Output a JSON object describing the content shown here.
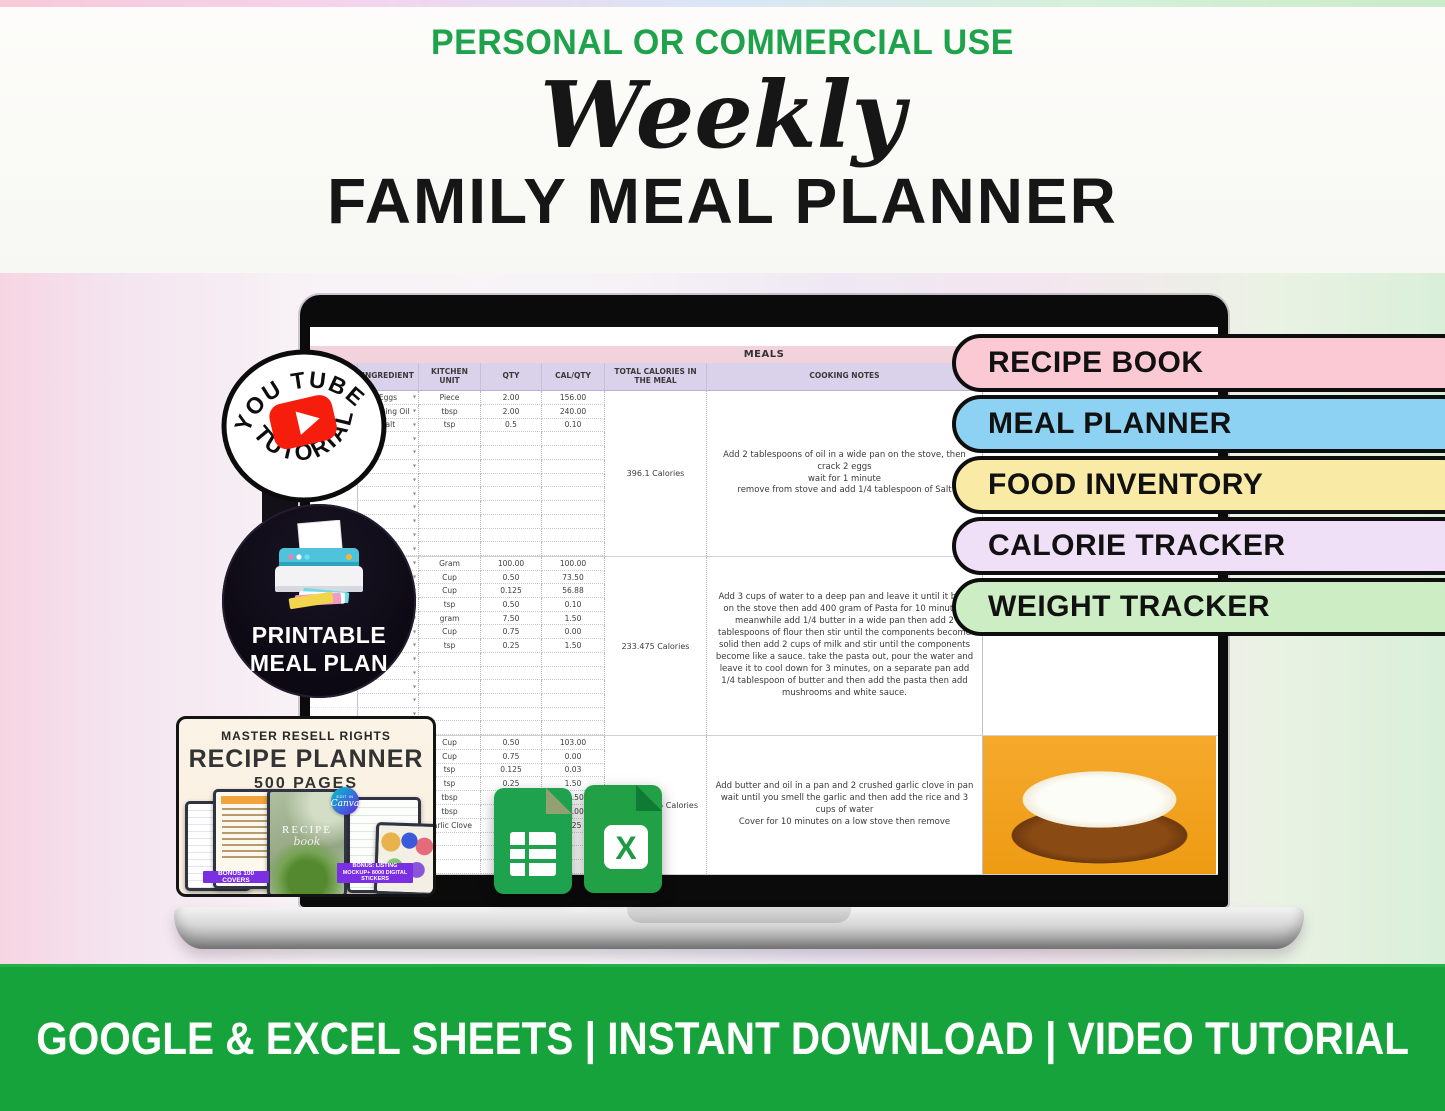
{
  "header": {
    "eyebrow": "PERSONAL OR COMMERCIAL USE",
    "script_title": "Weekly",
    "main_title": "FAMILY MEAL PLANNER"
  },
  "youtube_badge": {
    "top_text": "YOU TUBE",
    "bottom_text": "TUTORIAL"
  },
  "printable_badge": {
    "line1": "PRINTABLE",
    "line2": "MEAL PLAN"
  },
  "feature_pills": [
    {
      "label": "RECIPE BOOK",
      "color": "#fbc9d4"
    },
    {
      "label": "MEAL PLANNER",
      "color": "#8dd1f3"
    },
    {
      "label": "FOOD INVENTORY",
      "color": "#f9eaa6"
    },
    {
      "label": "CALORIE TRACKER",
      "color": "#efdff7"
    },
    {
      "label": "WEIGHT TRACKER",
      "color": "#cdeec5"
    }
  ],
  "spreadsheet": {
    "sheet_title": "MEALS",
    "columns": [
      "INGREDIENT",
      "KITCHEN UNIT",
      "QTY",
      "CAL/QTY",
      "TOTAL CALORIES IN THE MEAL",
      "COOKING NOTES"
    ],
    "meals": [
      {
        "rows": [
          {
            "ingredient": "Eggs",
            "unit": "Piece",
            "qty": "2.00",
            "cal": "156.00"
          },
          {
            "ingredient": "Cooking Oil",
            "unit": "tbsp",
            "qty": "2.00",
            "cal": "240.00"
          },
          {
            "ingredient": "Salt",
            "unit": "tsp",
            "qty": "0.5",
            "cal": "0.10"
          }
        ],
        "empty_rows": 9,
        "total": "396.1 Calories",
        "notes": "Add 2 tablespoons of oil in a wide pan on the stove, then crack 2 eggs\nwait for 1 minute\nremove from stove and add 1/4 tablespoon of Salt",
        "photo": ""
      },
      {
        "rows": [
          {
            "ingredient": "",
            "unit": "Gram",
            "qty": "100.00",
            "cal": "100.00"
          },
          {
            "ingredient": "",
            "unit": "Cup",
            "qty": "0.50",
            "cal": "73.50"
          },
          {
            "ingredient": "",
            "unit": "Cup",
            "qty": "0.125",
            "cal": "56.88"
          },
          {
            "ingredient": "",
            "unit": "tsp",
            "qty": "0.50",
            "cal": "0.10"
          },
          {
            "ingredient": "",
            "unit": "gram",
            "qty": "7.50",
            "cal": "1.50"
          },
          {
            "ingredient": "",
            "unit": "Cup",
            "qty": "0.75",
            "cal": "0.00"
          },
          {
            "ingredient": "",
            "unit": "tsp",
            "qty": "0.25",
            "cal": "1.50"
          }
        ],
        "empty_rows": 6,
        "total": "233.475 Calories",
        "notes": "Add 3 cups of water to a deep pan and leave it until it boils on the stove then add 400 gram of Pasta for 10 minutes, meanwhile add 1/4 butter in a wide pan then add 2 tablespoons of flour then stir until the components become solid then add 2 cups of milk and stir until the components become like a sauce. take the pasta out, pour the water and leave it to cool down for 3 minutes, on a separate pan add 1/4 tablespoon of butter and then add the pasta  then add mushrooms and white sauce.",
        "photo": "pasta"
      },
      {
        "rows": [
          {
            "ingredient": "",
            "unit": "Cup",
            "qty": "0.50",
            "cal": "103.00"
          },
          {
            "ingredient": "",
            "unit": "Cup",
            "qty": "0.75",
            "cal": "0.00"
          },
          {
            "ingredient": "",
            "unit": "tsp",
            "qty": "0.125",
            "cal": "0.03"
          },
          {
            "ingredient": "",
            "unit": "tsp",
            "qty": "0.25",
            "cal": "1.50"
          },
          {
            "ingredient": "",
            "unit": "tbsp",
            "qty": "",
            "cal": "25.50"
          },
          {
            "ingredient": "",
            "unit": "tbsp",
            "qty": "",
            "cal": "20.00"
          },
          {
            "ingredient": "",
            "unit": "Garlic Clove",
            "qty": "",
            "cal": "1.25"
          }
        ],
        "empty_rows": 3,
        "total": "5 Calories",
        "total_align": "right",
        "notes": "Add butter and oil in a pan and 2 crushed garlic clove in pan\nwait until you smell the garlic and then add the rice and 3 cups of water\nCover for 10 minutes on a low stove then remove",
        "photo": "rice"
      }
    ]
  },
  "resell_card": {
    "line1": "MASTER RESELL RIGHTS",
    "line2": "RECIPE PLANNER",
    "line3": "500 PAGES",
    "cover_title": "RECIPE",
    "cover_script": "book",
    "canva_small": "EDIT IN",
    "canva_label": "Canva",
    "banner_left": "BONUS 100 COVERS",
    "banner_right": "BONUS: LISTING MOCKUP+ 8000 DIGITAL STICKERS"
  },
  "footer": {
    "text": "GOOGLE & EXCEL SHEETS | INSTANT DOWNLOAD | VIDEO TUTORIAL"
  },
  "colors": {
    "accent_green": "#1fa24c",
    "footer_green": "#17a33b",
    "youtube_red": "#f61d0d",
    "sheets_green": "#1ea24d",
    "excel_green": "#1d9b43"
  }
}
